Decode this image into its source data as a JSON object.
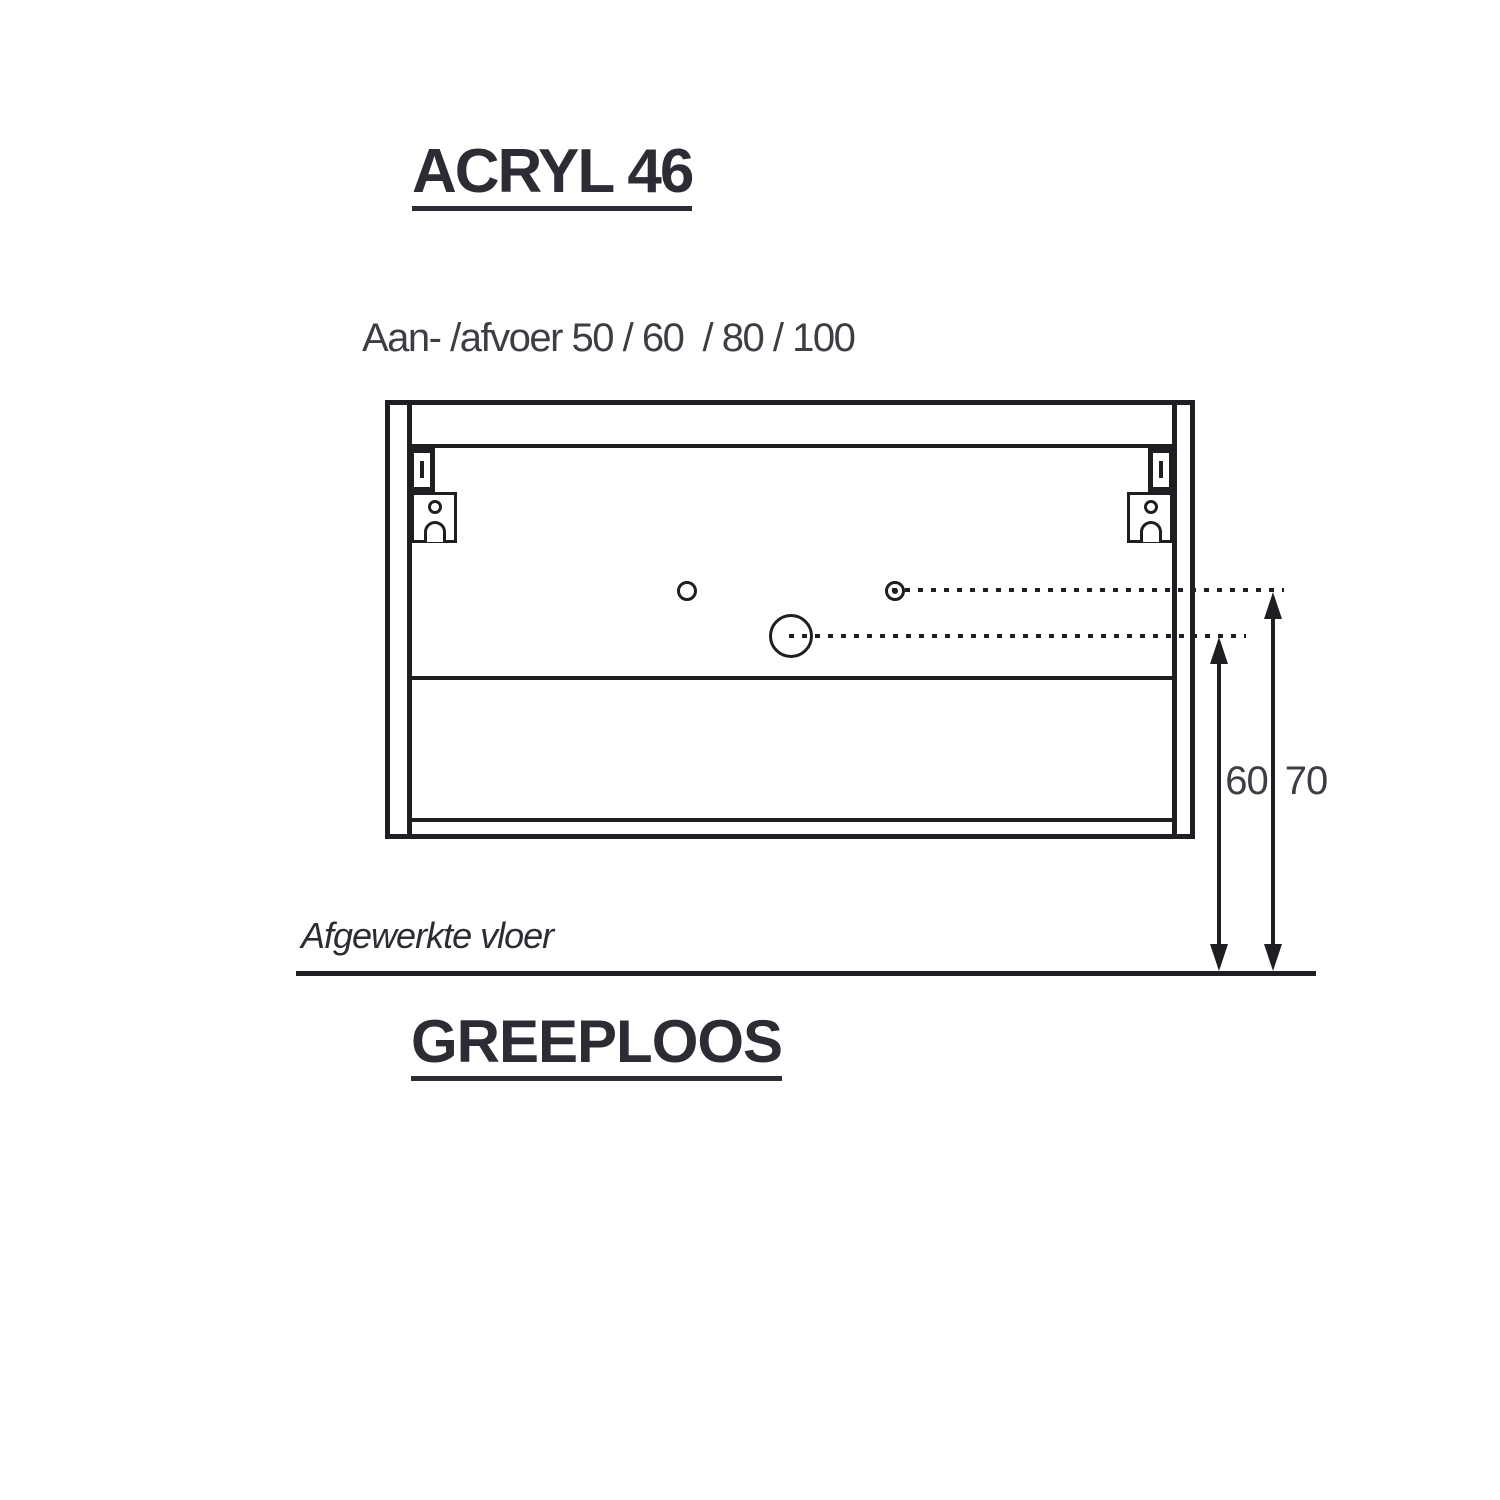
{
  "colors": {
    "background": "#ffffff",
    "ink": "#2c2c34",
    "line": "#1f1f23",
    "dim_text": "#3d3d46"
  },
  "header": {
    "title": "ACRYL 46",
    "subtitle": "Aan- /afvoer 50 / 60  / 80 / 100"
  },
  "diagram": {
    "floor_label": "Afgewerkte vloer",
    "dim_labels": {
      "inner": "60",
      "outer": "70"
    }
  },
  "footer": {
    "label": "GREEPLOOS"
  }
}
